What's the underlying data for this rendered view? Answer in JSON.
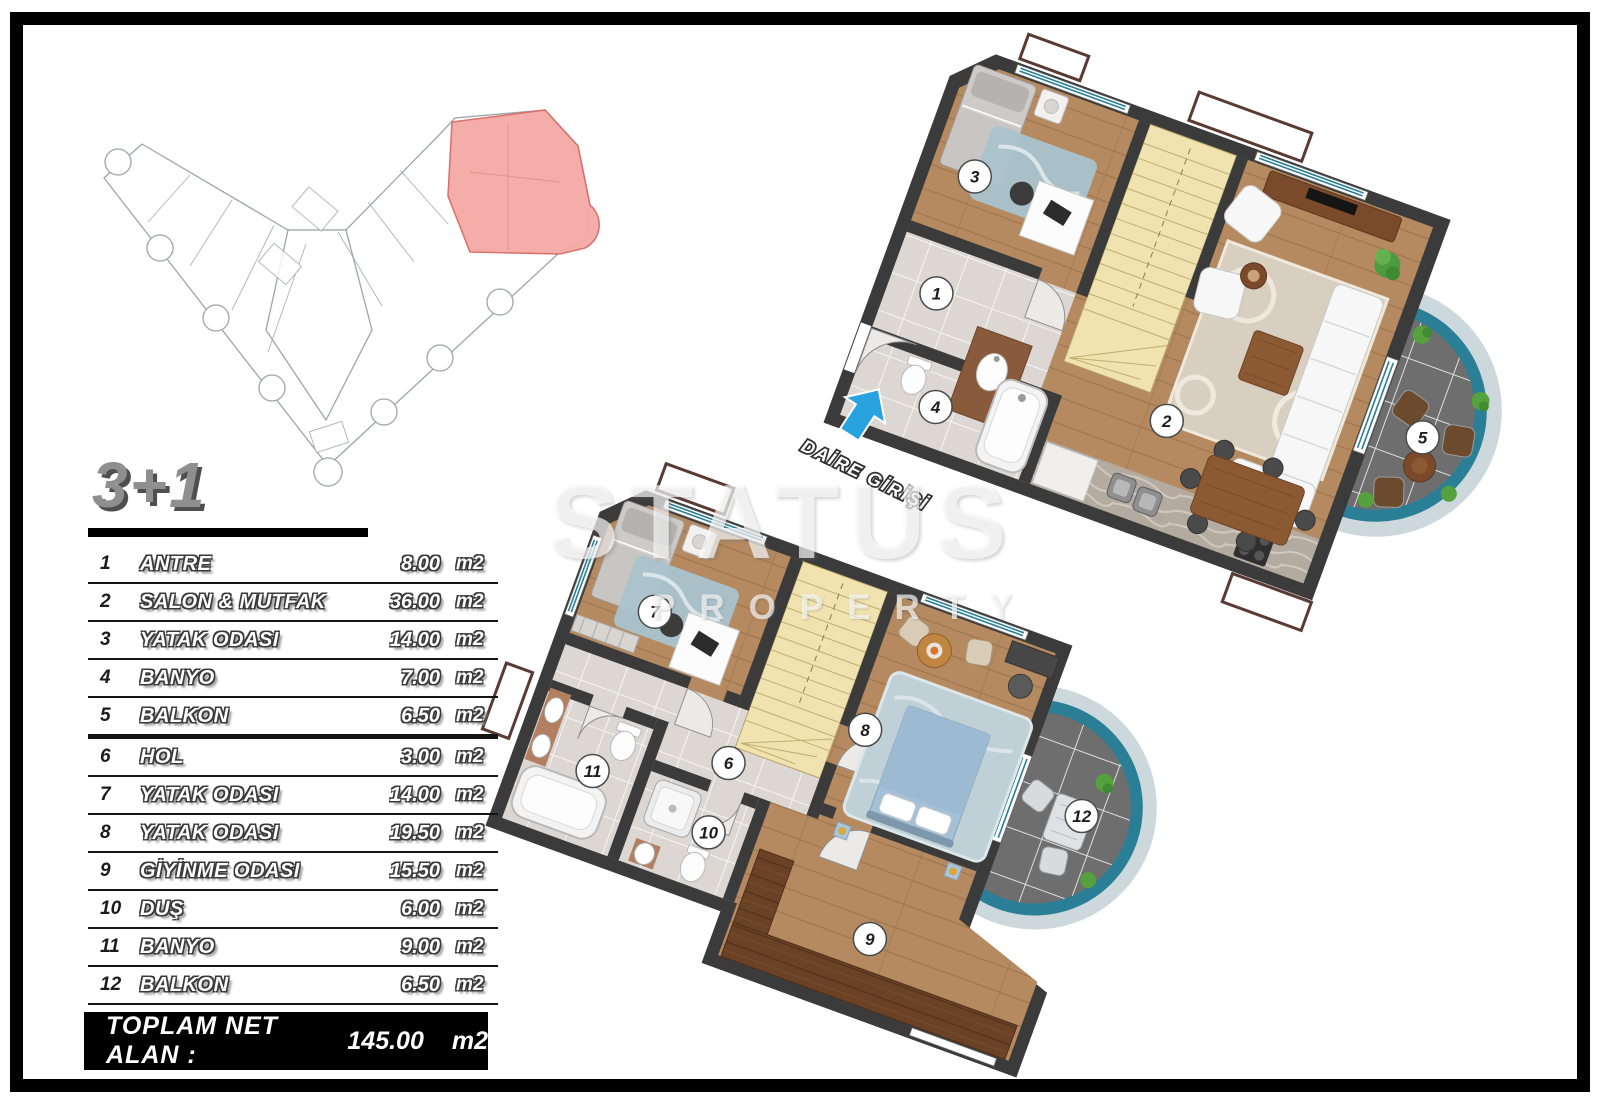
{
  "title": {
    "label": "3+1"
  },
  "watermark": {
    "line1": "STATUS",
    "line2": "PROPERTY"
  },
  "entrance": {
    "label": "DAİRE GİRİŞİ"
  },
  "area_table": {
    "rows": [
      {
        "no": "1",
        "name": "ANTRE",
        "area": "8.00",
        "unit": "m2"
      },
      {
        "no": "2",
        "name": "SALON & MUTFAK",
        "area": "36.00",
        "unit": "m2"
      },
      {
        "no": "3",
        "name": "YATAK ODASI",
        "area": "14.00",
        "unit": "m2"
      },
      {
        "no": "4",
        "name": "BANYO",
        "area": "7.00",
        "unit": "m2"
      },
      {
        "no": "5",
        "name": "BALKON",
        "area": "6.50",
        "unit": "m2"
      },
      {
        "no": "6",
        "name": "HOL",
        "area": "3.00",
        "unit": "m2"
      },
      {
        "no": "7",
        "name": "YATAK ODASI",
        "area": "14.00",
        "unit": "m2"
      },
      {
        "no": "8",
        "name": "YATAK ODASI",
        "area": "19.50",
        "unit": "m2"
      },
      {
        "no": "9",
        "name": "GİYİNME ODASI",
        "area": "15.50",
        "unit": "m2"
      },
      {
        "no": "10",
        "name": "DUŞ",
        "area": "6.00",
        "unit": "m2"
      },
      {
        "no": "11",
        "name": "BANYO",
        "area": "9.00",
        "unit": "m2"
      },
      {
        "no": "12",
        "name": "BALKON",
        "area": "6.50",
        "unit": "m2"
      }
    ],
    "total": {
      "label": "TOPLAM NET ALAN :",
      "value": "145.00",
      "unit": "m2"
    }
  },
  "colors": {
    "highlight_unit": "#f5a9a5",
    "wall": "#3b3b3b",
    "wood_floor": "#b58a60",
    "stairs": "#f1e3af",
    "tile": "#dcd7d2",
    "balcony_rim": "#2a7f97",
    "balcony_tile": "#6e6e6e",
    "entrance_arrow": "#29a3df"
  }
}
